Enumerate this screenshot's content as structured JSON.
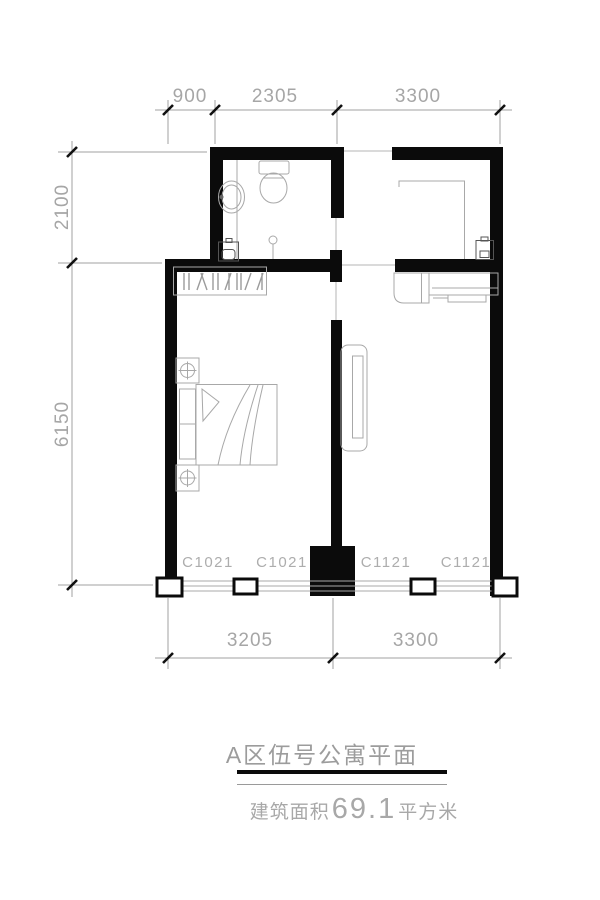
{
  "document": {
    "type": "apartment-floor-plan",
    "title": "A区伍号公寓平面",
    "area_label_prefix": "建筑面积",
    "area_value": "69.1",
    "area_label_suffix": "平方米"
  },
  "dimensions": {
    "top": [
      "900",
      "2305",
      "3300"
    ],
    "left": [
      "2100",
      "6150"
    ],
    "bottom": [
      "3205",
      "3300"
    ]
  },
  "window_labels": [
    "C1021",
    "C1021",
    "C1121",
    "C1121"
  ],
  "fixtures": [
    "toilet",
    "sink",
    "washing-machine",
    "shower-drain",
    "wardrobe",
    "double-bed",
    "nightstand-lamp",
    "tv-cabinet",
    "kitchen-counter",
    "cooktop-counter",
    "water-heater"
  ],
  "colors": {
    "wall": "#0b0b0b",
    "dimension_line": "#a0a0a0",
    "fixture_line": "#a8a8a8",
    "dark_fixture_line": "#555555",
    "text_gray": "#a6a6a6",
    "background": "#ffffff"
  }
}
